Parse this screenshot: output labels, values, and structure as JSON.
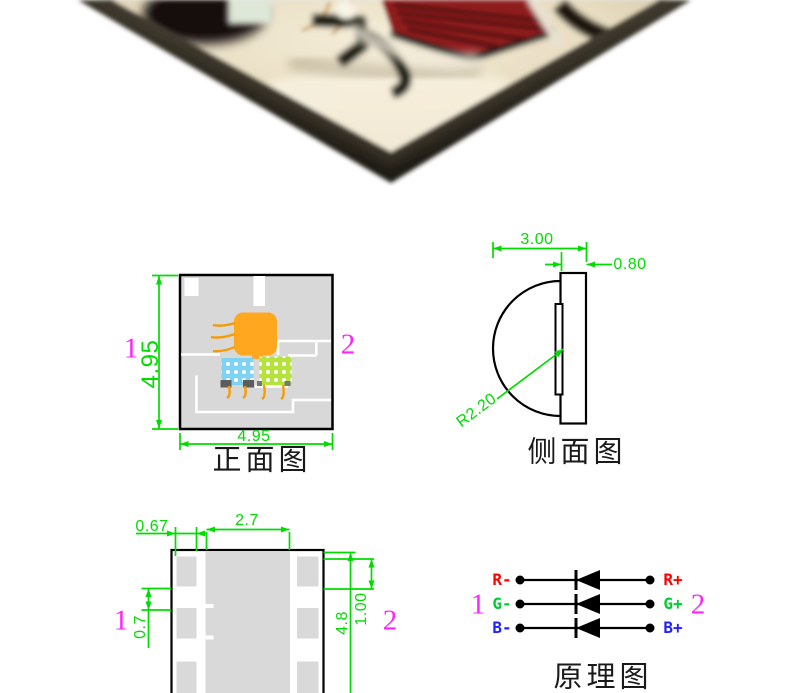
{
  "colors": {
    "dimension_green": "#00dc00",
    "pin_magenta": "#ff22ff",
    "outline_black": "#000000",
    "board_gray": "#d8d8d8",
    "die_orange": "#ffa71f",
    "die_blue": "#7ed3f0",
    "die_green": "#b5e23c",
    "photo_red_die": "#8e1b1e",
    "photo_ceramic": "#eee4cc"
  },
  "photo": {
    "description": "Macro photo of SMD RGB LED package corner"
  },
  "front_view": {
    "caption": "正面图",
    "dim_height": "4.95",
    "dim_width": "4.95",
    "pin_left_num": "1",
    "pin_right_num": "2"
  },
  "side_view": {
    "caption": "侧面图",
    "dim_depth": "3.00",
    "dim_body_width": "0.80",
    "dim_lens_radius": "R2.20"
  },
  "back_view": {
    "dim_pad_width": "0.67",
    "dim_center_width": "2.7",
    "dim_pad_gap": "0.7",
    "dim_total_height": "4.8",
    "dim_pad_height": "1.00",
    "pin_left_num": "1",
    "pin_right_num": "2"
  },
  "schematic": {
    "caption": "原理图",
    "pin_left_num": "1",
    "pin_right_num": "2",
    "rows": [
      {
        "neg": "R-",
        "pos": "R+",
        "color": "#ff0000"
      },
      {
        "neg": "G-",
        "pos": "G+",
        "color": "#00cc33"
      },
      {
        "neg": "B-",
        "pos": "B+",
        "color": "#2222ff"
      }
    ]
  }
}
